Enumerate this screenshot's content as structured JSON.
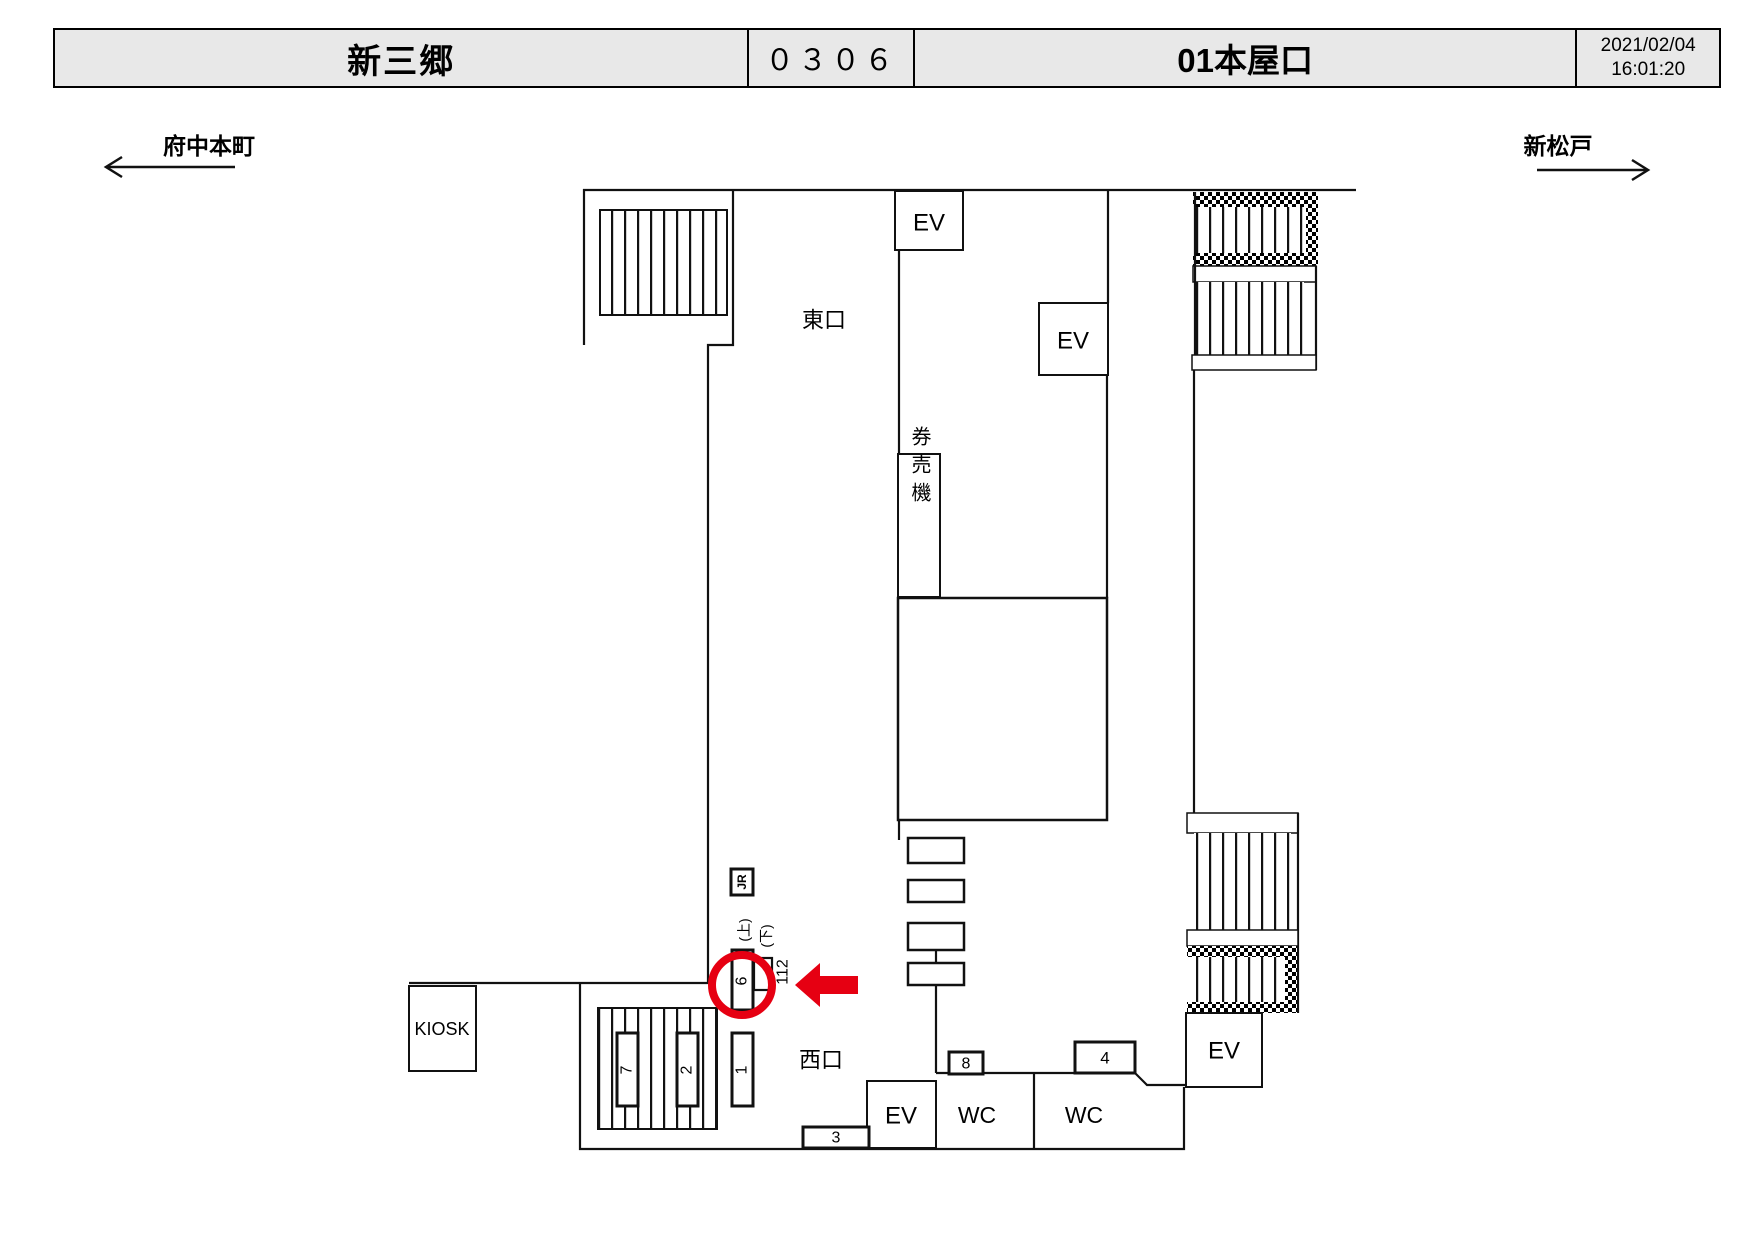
{
  "header": {
    "station_name": "新三郷",
    "station_code": "０３０６",
    "entrance_title": "01本屋口",
    "date": "2021/02/04",
    "time": "16:01:20"
  },
  "directions": {
    "left_station": "府中本町",
    "right_station": "新松戸"
  },
  "plan": {
    "east_exit": "東口",
    "west_exit": "西口",
    "kiosk": "KIOSK",
    "ticket_machines": "券売機",
    "elevator": "EV",
    "toilet": "WC",
    "jr_mark": "JR",
    "up_label": "(上)",
    "down_label": "(下)",
    "location_code": "112",
    "boards": {
      "b1": "1",
      "b2": "2",
      "b3": "3",
      "b4": "4",
      "b6": "6",
      "b7": "7",
      "b8": "8"
    }
  },
  "colors": {
    "highlight_red": "#e60012",
    "header_bg": "#e8e8e8",
    "line": "#111111"
  }
}
